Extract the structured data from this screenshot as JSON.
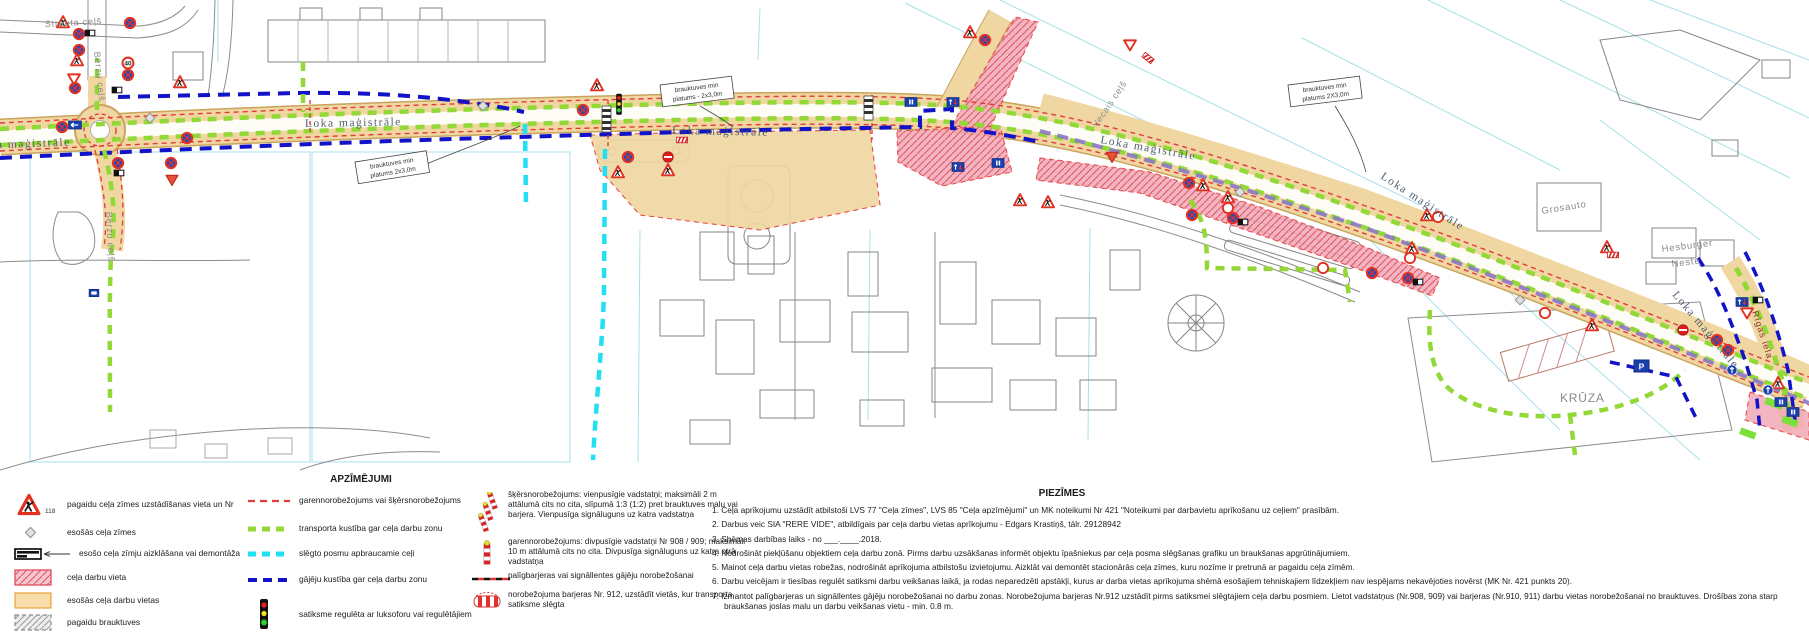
{
  "map": {
    "street_labels": [
      {
        "text": "Strauta ceļš"
      },
      {
        "text": "Bērzu ceļš"
      },
      {
        "text": "Bērzu ceļš"
      },
      {
        "text": "Loka maģistrāle"
      },
      {
        "text": "Loka maģistrāle"
      },
      {
        "text": "Loka maģistrāle"
      },
      {
        "text": "Loka maģistrāle"
      },
      {
        "text": "Loka maģistrāle"
      },
      {
        "text": "Loka maģistrāle"
      },
      {
        "text": "Vecais ceļš"
      },
      {
        "text": "Rīgas iela"
      }
    ],
    "place_labels": [
      {
        "text": "Grosauto"
      },
      {
        "text": "Hesburger"
      },
      {
        "text": "Neste"
      },
      {
        "text": "KRŪZA"
      }
    ],
    "callouts": [
      {
        "line1": "brauktuves min",
        "line2": "platums 2x3,0m"
      },
      {
        "line1": "brauktuves min",
        "line2": "platums - 2x3,0m"
      },
      {
        "line1": "brauktuves min",
        "line2": "platums 2X3,0m"
      }
    ],
    "speed_limit": "40",
    "parking_label": "P"
  },
  "legend": {
    "title": "APZĪMĒJUMI",
    "sign_sample_number": "118",
    "col1": [
      {
        "label": "pagaidu ceļa zīmes uzstādīšanas vieta un Nr"
      },
      {
        "label": "esošās ceļa zīmes"
      },
      {
        "label": "esošo ceļa zīmju aizklāšana vai demontāža"
      },
      {
        "label": "ceļa darbu vieta"
      },
      {
        "label": "esošās ceļa darbu vietas"
      },
      {
        "label": "pagaidu brauktuves"
      }
    ],
    "col2": [
      {
        "label": "garennorobežojums vai šķērsnorobežojums"
      },
      {
        "label": "transporta kustība gar ceļa darbu zonu"
      },
      {
        "label": "slēgto posmu apbraucamie ceļi"
      },
      {
        "label": "gājēju kustība gar ceļa darbu zonu"
      },
      {
        "label": "satiksme regulēta ar luksoforu vai regulētājiem"
      }
    ],
    "col3": [
      {
        "label": "šķērsnorobežojums: vienpusīgie vadstatņi; maksimāli 2 m attālumā cits no cita, slīpumā 1:3 (1:2) pret brauktuves malu vai barjera. Vienpusīga signāluguns uz katra vadstatņa"
      },
      {
        "label": "garennorobežojums: divpusīgie vadstatņi Nr 908 / 909; maksimāli 10 m attālumā cits no cita. Divpusīga signāluguns uz katra otrā vadstatņa"
      },
      {
        "label": "palīgbarjeras vai signāllentes gājēju norobežošanai"
      },
      {
        "label": "norobežojuma barjeras Nr. 912, uzstādīt vietās, kur transporta satiksme slēgta"
      }
    ]
  },
  "notes": {
    "title": "PIEZĪMES",
    "items": [
      {
        "text": "1. Ceļa aprīkojumu uzstādīt atbilstoši LVS 77 \"Ceļa zīmes\", LVS 85 \"Ceļa apzīmējumi\" un MK noteikumi Nr 421 \"Noteikumi par darbavietu aprīkošanu uz ceļiem\" prasībām."
      },
      {
        "text": "2. Darbus veic SIA \"RERE VIDE\", atbildīgais par ceļa darbu vietas aprīkojumu - Edgars Krastiņš, tālr. 29128942"
      },
      {
        "text": "3. Shēmas darbības laiks - no ___.____.2018."
      },
      {
        "text": "4. Nodrošināt piekļūšanu objektiem ceļa darbu zonā. Pirms darbu uzsākšanas informēt objektu īpašniekus par ceļa posma slēgšanas grafiku un braukšanas apgrūtinājumiem."
      },
      {
        "text": "5. Mainot ceļa darbu vietas robežas, nodrošināt aprīkojuma atbilstošu izvietojumu. Aizklāt vai demontēt stacionārās ceļa zīmes, kuru nozīme ir pretrunā ar pagaidu ceļa zīmēm."
      },
      {
        "text": "6. Darbu veicējam ir tiesības regulēt satiksmi darbu veikšanas laikā, ja rodas neparedzēti apstākļi, kurus ar darba vietas aprīkojuma shēmā esošajiem tehniskajiem līdzekļiem nav iespējams nekavējoties novērst (MK Nr. 421 punkts 20)."
      },
      {
        "text": "7. Izmantot palīgbarjeras un signāllentes gājēju norobežošanai no darbu zonas. Norobežojuma barjeras Nr.912 uzstādīt pirms satiksmei slēgtajiem ceļa darbu posmiem. Lietot vadstatņus (Nr.908, 909) vai barjeras (Nr.910, 911) darbu vietas norobežošanai no brauktuves. Drošības zona starp braukšanas joslas malu un darbu veikšanas vietu - min. 0.8 m."
      }
    ]
  },
  "colors": {
    "work_zone_pink": "#f2aab6",
    "existing_work_zone_tan": "#f0d6a0",
    "transport_route_green": "#92d837",
    "detour_route_cyan": "#22dff2",
    "pedestrian_route_blue": "#1212c8",
    "barrier_red": "#e23b3b",
    "sign_blue": "#1b3fae",
    "parcel_cyan": "#a8dfeb"
  },
  "icons": {
    "road-works-sign-icon": "red-triangle-with-worker",
    "no-stopping-sign-icon": "blue-circle-red-x",
    "give-way-sign-icon": "inverted-red-triangle",
    "no-entry-sign-icon": "red-circle-white-bar",
    "speed-limit-sign-icon": "red-ring-with-number",
    "info-sign-icon": "blue-rectangle",
    "priority-sign-icon": "blue-rectangle-two-arrows",
    "mandatory-direction-sign-icon": "blue-circle-white-arrow",
    "existing-sign-icon": "gray-diamond",
    "covered-sign-icon": "black-white-plate-with-arrow",
    "barrier-912-icon": "red-white-striped-barrier",
    "traffic-light-icon": "red-yellow-green-lights",
    "bus-stop-sign-icon": "blue-rectangle-bus",
    "delineator-post-icon": "red-white-striped-post-with-lamp"
  }
}
